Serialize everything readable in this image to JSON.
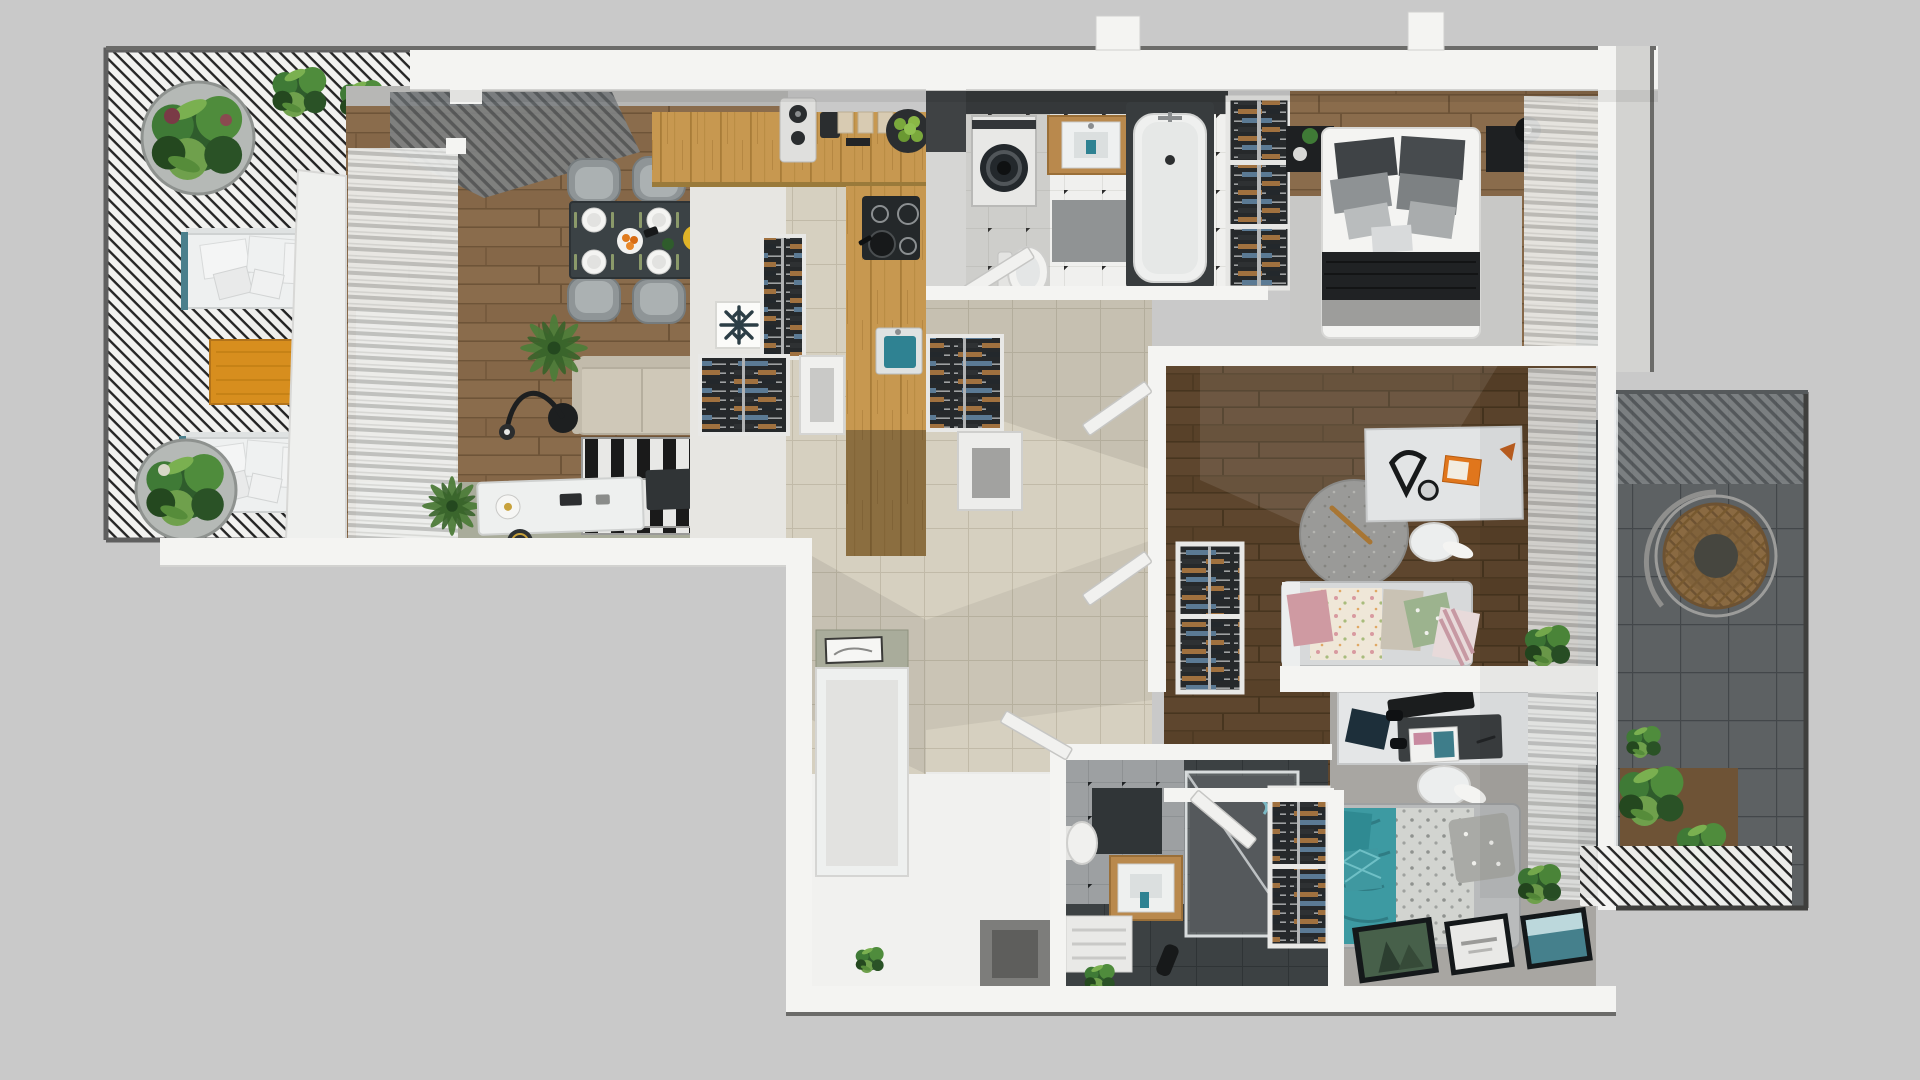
{
  "meta": {
    "title": "Apartment 3D Floor Plan — Top-Down Render",
    "view": "top-down orthographic 3D render",
    "canvas": "1920x1080"
  },
  "palette": {
    "bg": "#c9c9c9",
    "wall": "#f4f4f2",
    "wallEdge": "#d2d2d0",
    "outline": "#5f5f5f",
    "woodLight": "#8a6c4c",
    "woodDark": "#5e462e",
    "oak": "#c79850",
    "tileDark": "#5d6163",
    "tileBeige": "#d6d0c0",
    "tileWhite": "#f0f0ee",
    "tileGray": "#9da0a2",
    "charcoal": "#3c4143",
    "rugLight": "#c8c8c6",
    "rugRound": "#9a9a98",
    "carpet": "#a8a6a2",
    "sage": "#a9ac9b",
    "sofaBeige": "#cfc8b8",
    "tableDark": "#3b4245",
    "chairGray": "#9ba1a3",
    "orange": "#d78e1e",
    "bookOrange": "#e0761c",
    "teal": "#3d9aa2",
    "sinkTeal": "#2f8292",
    "green": "#3f7a38",
    "greenDark": "#2a5226",
    "black": "#1b1d1e",
    "pink": "#cf9aa2",
    "pillowGreen": "#9cb38e",
    "floralBase": "#efe7d8",
    "rattan": "#8a6a42",
    "clothesBrown": "#a0713f",
    "clothesBlue": "#5b7a94",
    "posterGreen": "#47604a",
    "posterTeal": "#45808c",
    "white": "#f6f6f4",
    "grayMat": "#909394"
  },
  "scene": {
    "rooms": [
      {
        "id": "terrace",
        "name": "Left terrace",
        "furniture": [
          "louvered pergola",
          "round concrete planters (2)",
          "white outdoor sofas (2)",
          "orange wood coffee table",
          "potted plants"
        ]
      },
      {
        "id": "living-dining",
        "name": "Living and dining room",
        "furniture": [
          "dark dining table",
          "upholstered chairs (6)",
          "place settings (6)",
          "beige sofa",
          "black and white striped rug",
          "dark media console",
          "arc floor lamp",
          "palm plants",
          "window blinds",
          "gray drape",
          "white sideboard"
        ]
      },
      {
        "id": "kitchen",
        "name": "Kitchen",
        "furniture": [
          "L-shaped oak counter",
          "black cooktop with pan",
          "teal sink",
          "speaker",
          "coffee machine",
          "cutting boards",
          "bowl of green apples",
          "snowflake fridge marker",
          "wardrobe units"
        ]
      },
      {
        "id": "hallway",
        "name": "Hallway",
        "furniture": [
          "hanger closet",
          "shoe cabinet",
          "open doors"
        ]
      },
      {
        "id": "bathroom-1",
        "name": "Main bathroom",
        "furniture": [
          "washing machine",
          "wood vanity with sink",
          "bathtub",
          "toilet",
          "shower mat"
        ]
      },
      {
        "id": "wardrobe-strip",
        "name": "Built-in wardrobe",
        "furniture": [
          "three hanger sections"
        ]
      },
      {
        "id": "master-bedroom",
        "name": "Master bedroom",
        "furniture": [
          "double bed with dark throw",
          "nightstands (2)",
          "black table lamp",
          "light area rug",
          "window blinds"
        ]
      },
      {
        "id": "kids-room",
        "name": "Kids room",
        "furniture": [
          "white desk",
          "desk lamp",
          "orange book",
          "white chair",
          "round gray rug",
          "daybed with floral blanket",
          "pink / green / striped pillows",
          "hanger wardrobe",
          "plant"
        ]
      },
      {
        "id": "teen-room",
        "name": "Teen bedroom",
        "furniture": [
          "white desk",
          "keyboard",
          "mousepad",
          "magazine",
          "notebook",
          "gamepads (2)",
          "white chair",
          "teal bed with gray pillows",
          "floor posters (3)",
          "plant"
        ]
      },
      {
        "id": "bathroom-2",
        "name": "Shower bathroom",
        "furniture": [
          "glass walk-in shower",
          "wood vanity with sink",
          "toilet",
          "bench",
          "hanger wardrobe"
        ]
      },
      {
        "id": "entry",
        "name": "Entry",
        "furniture": [
          "white cabinet with sage top",
          "tray",
          "bench",
          "wall niche",
          "plant"
        ]
      },
      {
        "id": "balcony-right",
        "name": "Right balcony",
        "furniture": [
          "hanging rattan chair",
          "louvered roof",
          "planter box with plants",
          "striped pergola strip"
        ]
      }
    ]
  }
}
